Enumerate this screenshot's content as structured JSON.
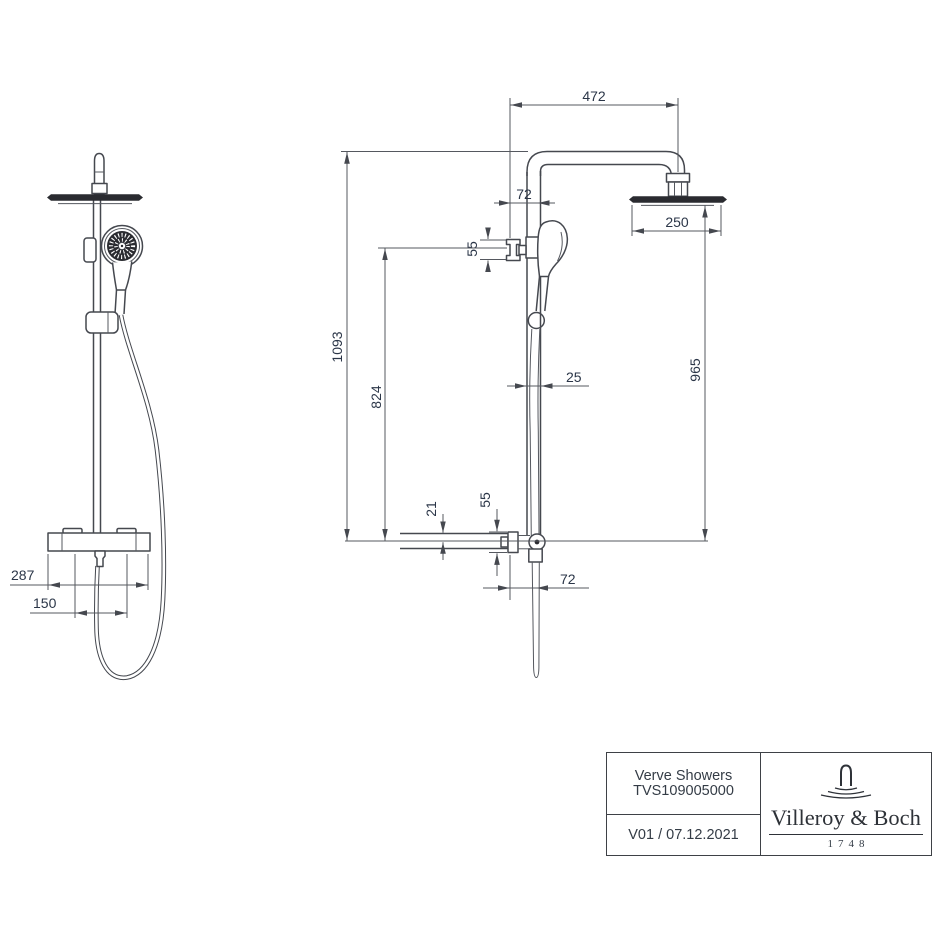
{
  "drawing": {
    "side_view_dims": {
      "arm_reach": "472",
      "wall_to_rail": "72",
      "holder_knob_height": "55",
      "rain_head_width": "250",
      "overall_height": "1093",
      "holder_height": "824",
      "rain_head_height": "965",
      "rail_diameter": "25",
      "inlet_offset": "21",
      "wall_bracket_height": "55",
      "wall_to_hose": "72"
    },
    "front_view_dims": {
      "trim_width": "287",
      "connection_spacing": "150"
    },
    "colors": {
      "ink": "#45484f",
      "dim_text": "#2b3648",
      "dark_fill": "#2a2b30"
    }
  },
  "title_block": {
    "product_line": "Verve Showers",
    "article_number": "TVS109005000",
    "version_date": "V01 / 07.12.2021",
    "brand": {
      "name": "Villeroy & Boch",
      "year": "1748"
    }
  }
}
